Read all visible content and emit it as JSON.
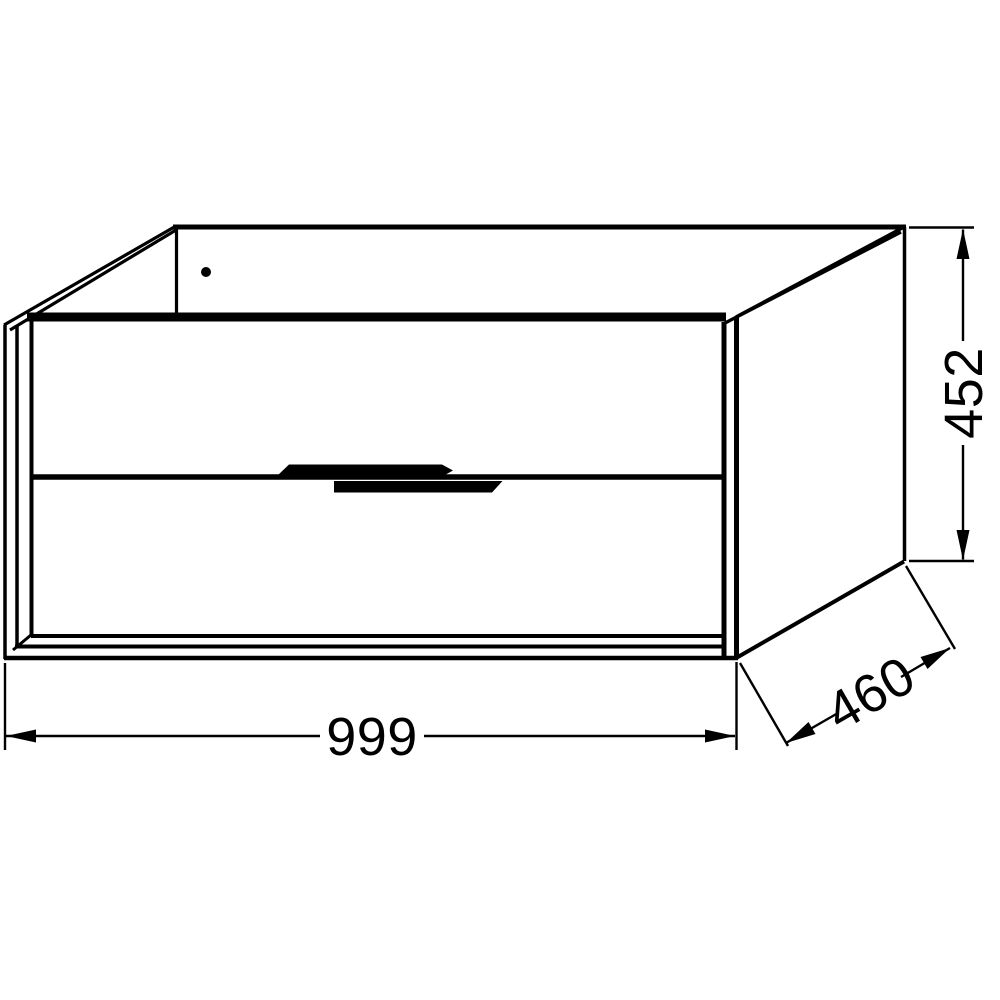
{
  "figure": {
    "kind": "technical line drawing",
    "subject": "two-drawer wall-hung vanity cabinet, perspective view"
  },
  "dimensions": {
    "width_mm": "999",
    "depth_mm": "460",
    "height_mm": "452"
  },
  "colors": {
    "line": "#000000",
    "background": "#ffffff"
  }
}
